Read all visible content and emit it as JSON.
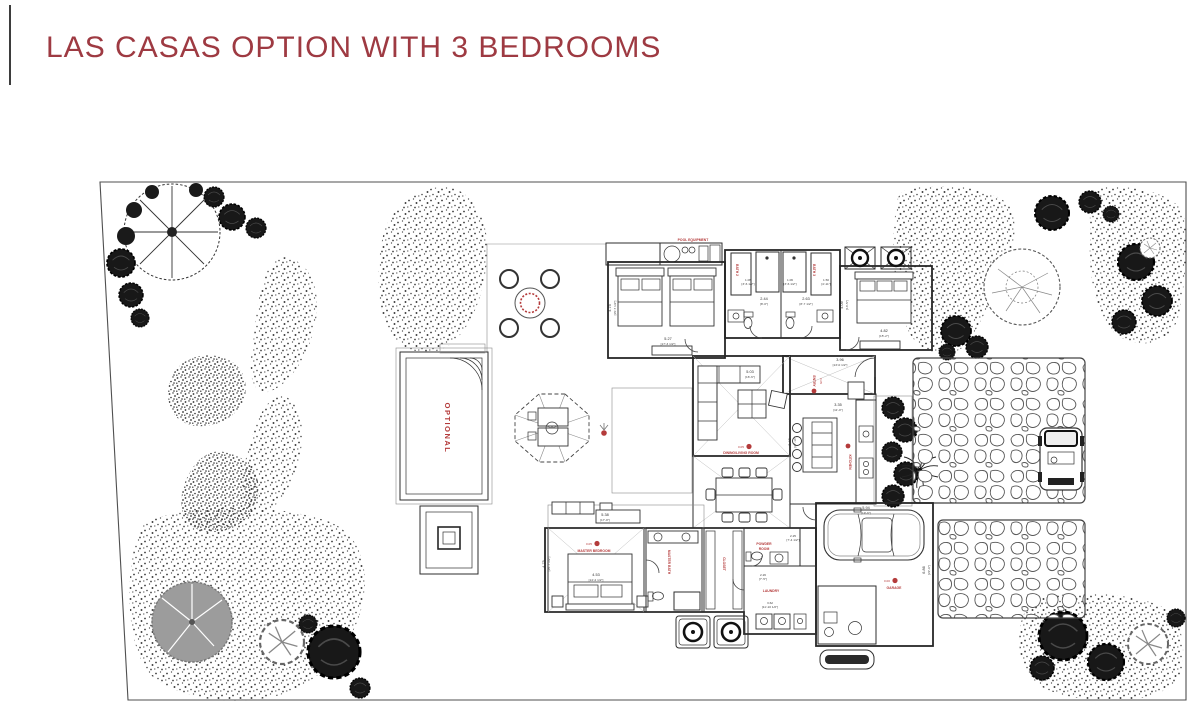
{
  "page": {
    "title": "LAS CASAS OPTION WITH 3 BEDROOMS",
    "background": "#ffffff",
    "title_color": "#9e3a42",
    "label_color": "#b43b3b",
    "line_color": "#2e2e2e"
  },
  "plan": {
    "labels": {
      "pool_equipment": "POOL EQUIPMENT",
      "optional": "OPTIONAL",
      "bath2": "BATH 2",
      "bath3": "BATH 3",
      "dining_living": "DINING/LIVING ROOM",
      "kitchen": "KITCHEN",
      "entry": "ENTRY",
      "master_bedroom": "MASTER BEDROOM",
      "master_bath": "MASTER BATH",
      "closet": "CLOSET",
      "powder_line1": "POWDER",
      "powder_line2": "ROOM",
      "laundry": "LAUNDRY",
      "garage": "GARAGE"
    },
    "levels": {
      "main": "0.05",
      "garage": "0.00"
    },
    "dims": {
      "bedroom2_w": "5.27",
      "bedroom2_w_ft": "[17'-3 1/2\"]",
      "bedroom2_d": "4.75",
      "bedroom2_d_ft": "[15'-7 1/2\"]",
      "bedroom3_w": "4.82",
      "bedroom3_w_ft": "[15'-2\"]",
      "bedroom3_d": "4.09",
      "bedroom3_d_ft": "[13'-5\"]",
      "bath2_w": "2.44",
      "bath2_w_ft": "[8'-0\"]",
      "bath3_w": "2.63",
      "bath3_w_ft": "[8'-7 1/2\"]",
      "shower_w": "1.06",
      "shower_w_ft": "[3'-6 1/2\"]",
      "closet2_w": "1.50",
      "closet2_w_ft": "[4'-11\"]",
      "entry_w": "3.96",
      "entry_w_ft": "[13'-0 1/2\"]",
      "living_w": "5.03",
      "living_w_ft": "[16'-6\"]",
      "living_d": "8.48",
      "living_d_ft": "[27'-10\"]",
      "kitchen_w": "3.35",
      "kitchen_w_ft": "[11'-0\"]",
      "master_w": "5.38",
      "master_w_ft": "[17'-8\"]",
      "master_bed": "4.53",
      "master_bed_ft": "[14'-2 1/2\"]",
      "master_d": "4.75",
      "master_d_ft": "[15'-7 1/2\"]",
      "powder_w": "2.25",
      "powder_w_ft": "[7'-4 1/2\"]",
      "laundry_w": "2.26",
      "laundry_w_ft": "[7'-5\"]",
      "laundry_l": "3.62",
      "laundry_l_ft": "[11'-10 1/2\"]",
      "garage_w": "5.94",
      "garage_w_ft": "[19'-6\"]",
      "garage_d": "6.86",
      "garage_d_ft": "[22'-6\"]"
    }
  }
}
